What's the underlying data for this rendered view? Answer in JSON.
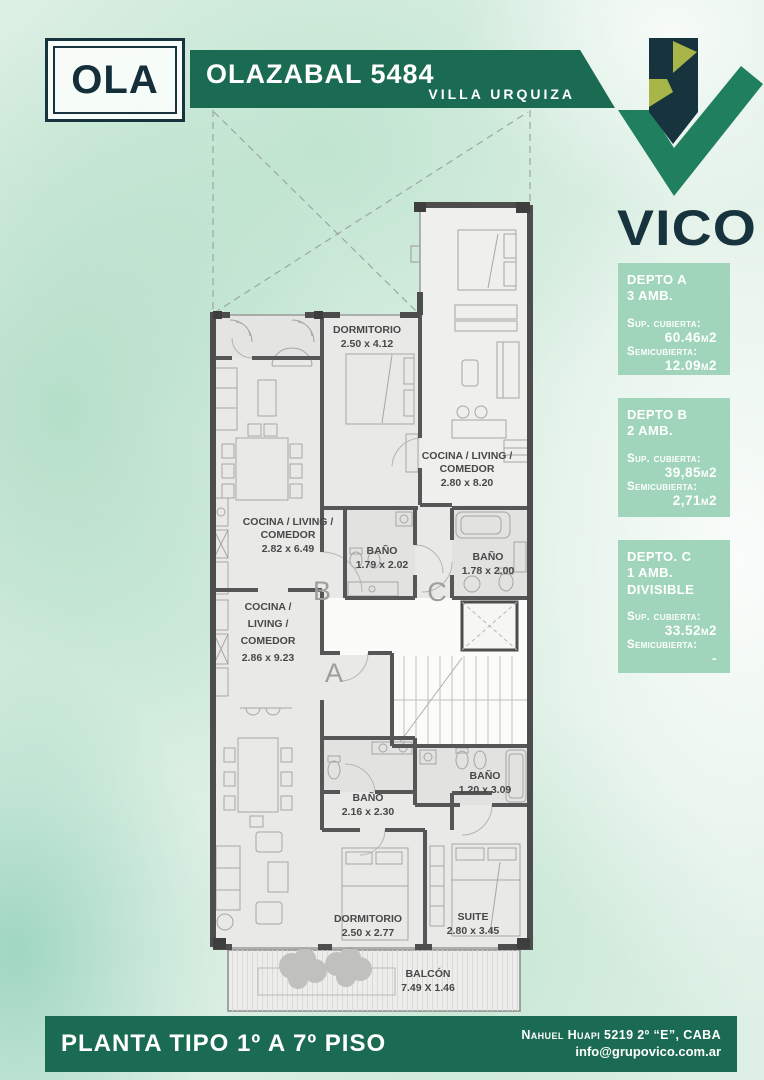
{
  "header": {
    "logo": "OLA",
    "title": "OLAZABAL 5484",
    "subtitle": "VILLA URQUIZA",
    "brand": "VICO"
  },
  "units": [
    {
      "name": "DEPTO A",
      "rooms": "3 AMB.",
      "covered_label": "Sup. cubierta:",
      "covered": "60.46m2",
      "semi_label": "Semicubierta:",
      "semi": "12.09m2"
    },
    {
      "name": "DEPTO B",
      "rooms": "2 AMB.",
      "covered_label": "Sup. cubierta:",
      "covered": "39,85m2",
      "semi_label": "Semicubierta:",
      "semi": "2,71m2"
    },
    {
      "name": "DEPTO. C",
      "rooms": "1 AMB.",
      "divisible": "DIVISIBLE",
      "covered_label": "Sup. cubierta:",
      "covered": "33.52m2",
      "semi_label": "Semicubierta:",
      "semi": "-"
    }
  ],
  "plan": {
    "letters": {
      "a": "A",
      "b": "B",
      "c": "C"
    },
    "rooms": {
      "dorm_b": {
        "l1": "DORMITORIO",
        "l2": "2.50 x 4.12"
      },
      "cocina_c": {
        "l1": "COCINA / LIVING /",
        "l2": "COMEDOR",
        "l3": "2.80 x 8.20"
      },
      "cocina_b": {
        "l1": "COCINA / LIVING /",
        "l2": "COMEDOR",
        "l3": "2.82 x 6.49"
      },
      "bano_b": {
        "l1": "BAÑO",
        "l2": "1.79 x 2.02"
      },
      "bano_c": {
        "l1": "BAÑO",
        "l2": "1.78 x 2.00"
      },
      "cocina_a": {
        "l1": "COCINA /",
        "l2": "LIVING /",
        "l3": "COMEDOR",
        "l4": "2.86 x 9.23"
      },
      "bano_a": {
        "l1": "BAÑO",
        "l2": "2.16 x 2.30"
      },
      "bano_suite": {
        "l1": "BAÑO",
        "l2": "1.20 x 3.09"
      },
      "dorm_a": {
        "l1": "DORMITORIO",
        "l2": "2.50 x 2.77"
      },
      "suite": {
        "l1": "SUITE",
        "l2": "2.80 x 3.45"
      },
      "balcon": {
        "l1": "BALCÓN",
        "l2": "7.49 X 1.46"
      }
    }
  },
  "footer": {
    "title": "PLANTA TIPO 1º A 7º PISO",
    "address": "Nahuel Huapi 5219 2º “E”, CABA",
    "email": "info@grupovico.com.ar"
  },
  "colors": {
    "brand_green": "#1b6b53",
    "panel_green": "#a0d5bb",
    "logo_navy": "#17333e",
    "logo_olive": "#a8b548",
    "logo_green": "#1f7f5f"
  }
}
